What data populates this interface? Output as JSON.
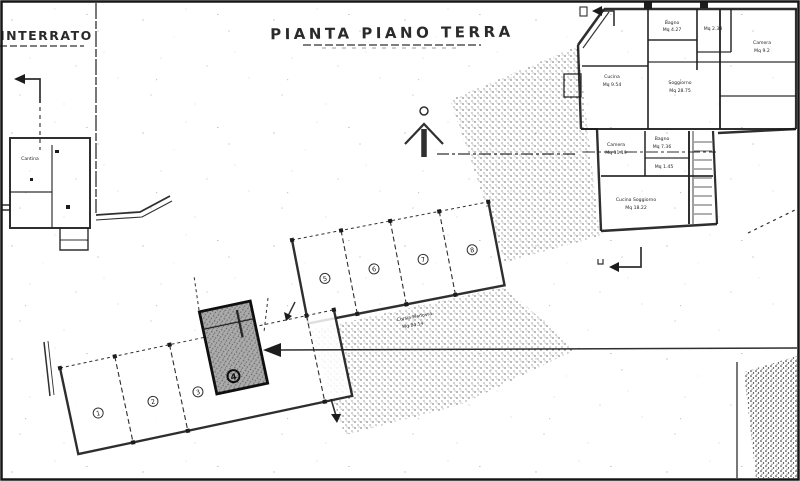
{
  "page": {
    "title_main": "PIANTA PIANO TERRA",
    "title_corner": "INTERRATO"
  },
  "colors": {
    "ink": "#1c1c1c",
    "paper": "#ffffff",
    "highlight_fill": "#ababab"
  },
  "left_building": {
    "room": "Cantina"
  },
  "right_building": {
    "rooms": {
      "bagno_top": {
        "name": "Bagno",
        "area": "Mq 4.27"
      },
      "ripostiglio": {
        "area": "Mq 2.38"
      },
      "camera_est": {
        "name": "Camera",
        "area": "Mq 9.2"
      },
      "cucina": {
        "name": "Cucina",
        "area": "Mq 9.54"
      },
      "soggiorno": {
        "name": "Soggiorno",
        "area": "Mq 28.75"
      },
      "camera_ovest": {
        "name": "Camera",
        "area": "Mq 11.19"
      },
      "bagno_centro": {
        "name": "Bagno",
        "area": "Mq 7.36"
      },
      "wc": {
        "area": "Mq 1.45"
      },
      "cucina_soggiorno": {
        "name": "Cucina Soggiorno",
        "area": "Mq 18.22"
      }
    }
  },
  "parking": {
    "corsia_label_line1": "Corsia Manovra",
    "corsia_label_line2": "Mq 84.14",
    "block_a_stalls": [
      "5",
      "6",
      "7",
      "8"
    ],
    "block_b_stalls": [
      "1",
      "2",
      "3"
    ],
    "highlighted_stall": "4"
  }
}
